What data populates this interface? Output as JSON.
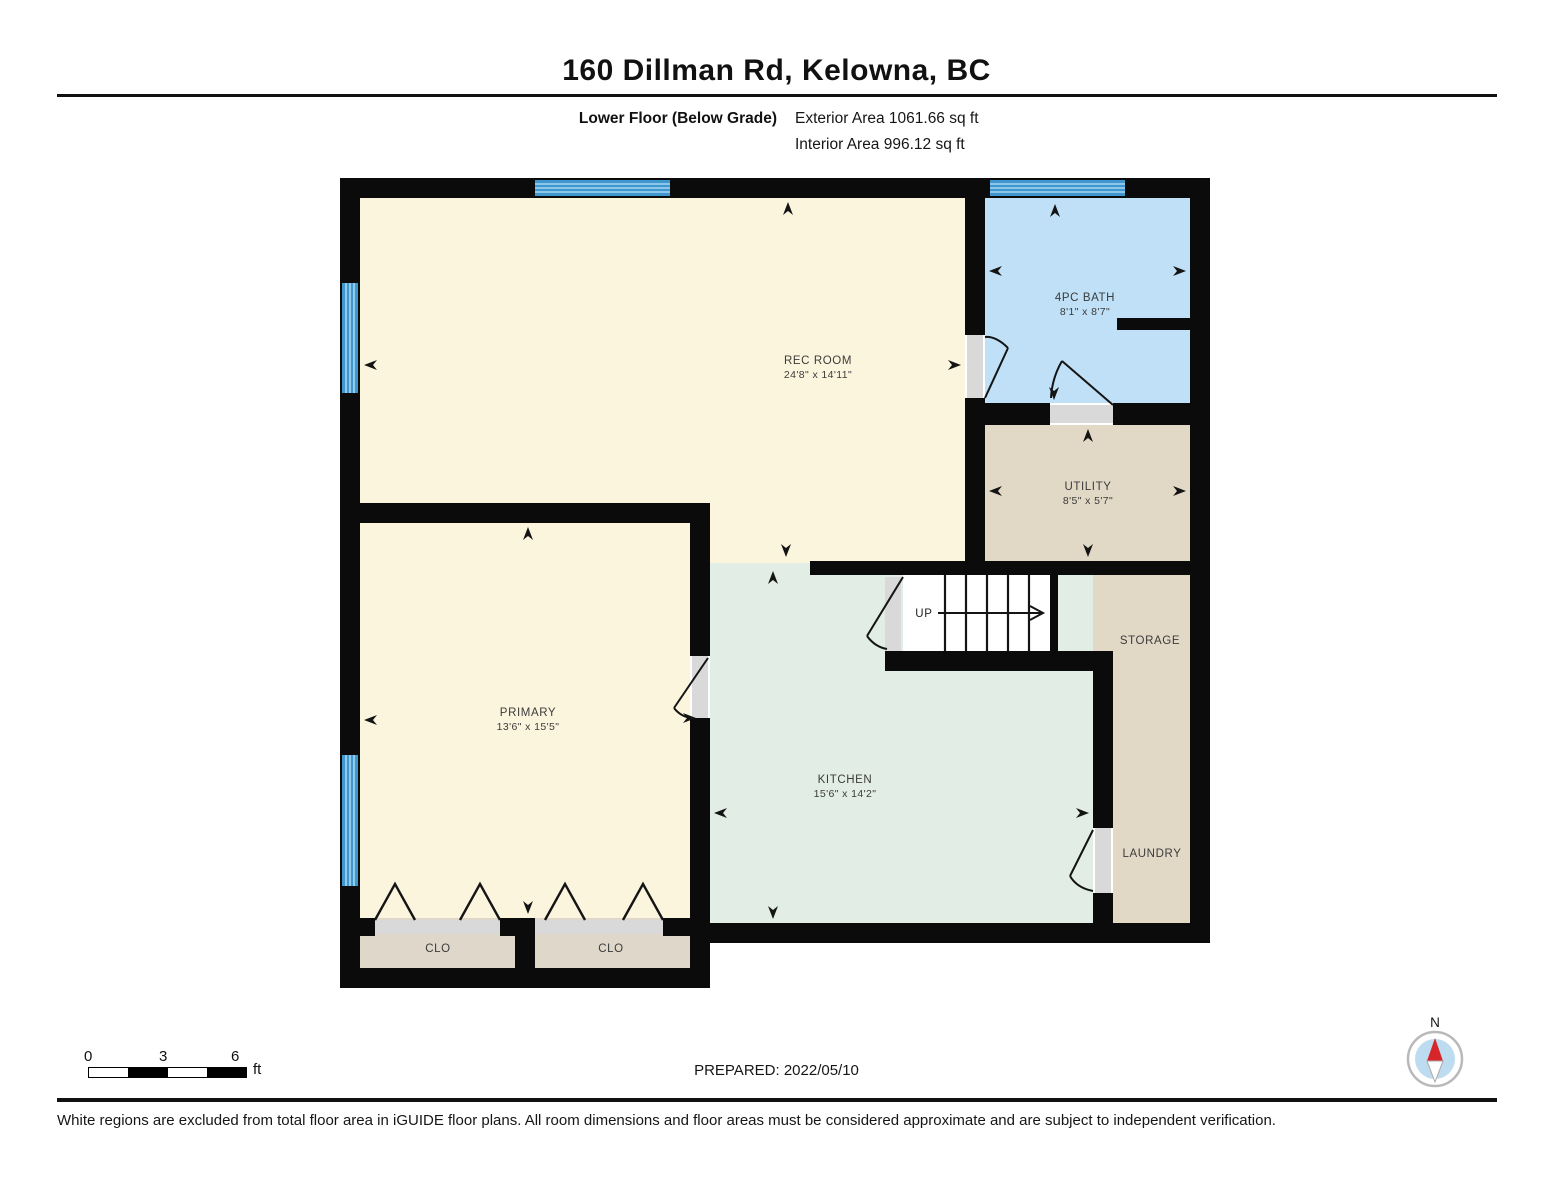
{
  "header": {
    "title": "160 Dillman Rd, Kelowna, BC",
    "floor_label": "Lower Floor (Below Grade)",
    "exterior_area": "Exterior Area 1061.66 sq ft",
    "interior_area": "Interior Area 996.12 sq ft"
  },
  "plan": {
    "rooms": {
      "rec": {
        "name": "REC ROOM",
        "dims": "24'8\" x 14'11\""
      },
      "bath": {
        "name": "4PC BATH",
        "dims": "8'1\" x 8'7\""
      },
      "utility": {
        "name": "UTILITY",
        "dims": "8'5\" x 5'7\""
      },
      "primary": {
        "name": "PRIMARY",
        "dims": "13'6\" x 15'5\""
      },
      "kitchen": {
        "name": "KITCHEN",
        "dims": "15'6\" x 14'2\""
      },
      "storage": {
        "name": "STORAGE"
      },
      "laundry": {
        "name": "LAUNDRY"
      },
      "closet1": {
        "name": "CLO"
      },
      "closet2": {
        "name": "CLO"
      },
      "stairs": {
        "label": "UP"
      }
    }
  },
  "scale_bar": {
    "tick0": "0",
    "tick1": "3",
    "tick2": "6",
    "unit": "ft"
  },
  "footer": {
    "prepared": "PREPARED: 2022/05/10",
    "compass_label": "N",
    "disclaimer": "White regions are excluded from total floor area in iGUIDE floor plans. All room dimensions and floor areas must be considered approximate and are subject to independent verification."
  },
  "colors": {
    "wall": "#0b0b0b",
    "room_cream": "#FCF5DE",
    "room_blue": "#BFE0F6",
    "room_tan": "#E2D8C6",
    "room_mint": "#E2EDE5",
    "room_closet": "#DFD7C9",
    "window_blue": "#3E97CF",
    "threshold_gray": "#D9D9D9",
    "compass_red": "#D8252A"
  }
}
